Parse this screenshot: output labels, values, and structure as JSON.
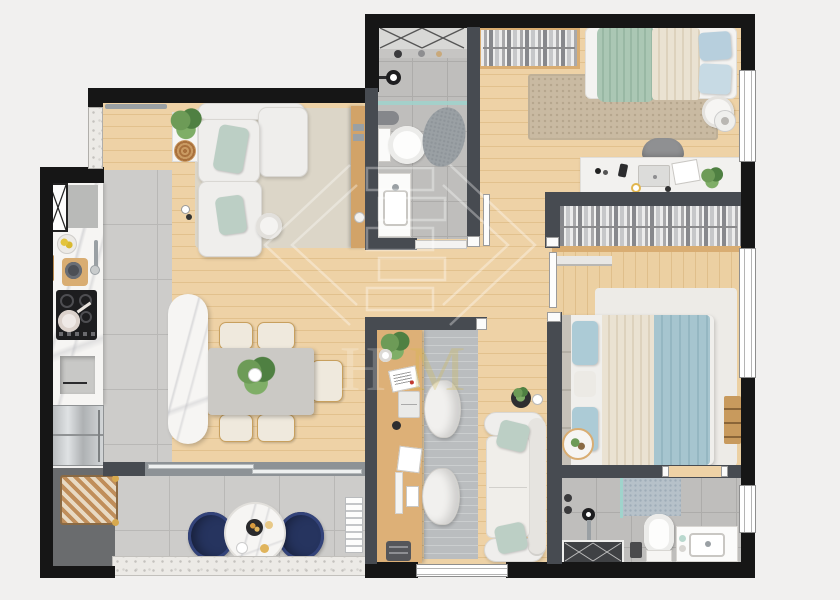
{
  "title": "3D apartment floor plan render",
  "watermark": {
    "letter_h": "H",
    "letter_m": "M",
    "letter_m_color": "#d4b83c",
    "line_color": "#ffffff"
  },
  "palette": {
    "background": "#f1f0ef",
    "outer_wall": "#161616",
    "inner_wall": "#474b51",
    "wood_floor": "#ecd0a2",
    "gray_tile": "#cdccca",
    "bath_tile": "#bfbebc",
    "marble": "#f6f5f3",
    "sofa_white": "#efeeec",
    "mint_pillow": "#bccfc5",
    "sage_bedding": "#abc7b4",
    "cream_bedding": "#eae2d2",
    "sky_pillow": "#b7cfdd",
    "master_blue_bedding": "#a6c5cf",
    "navy_chair": "#26345f",
    "beige_rug": "#d9d2c4",
    "office_rug": "#babdbf",
    "desk_wood": "#ddb077",
    "glass": "#9fd4cc",
    "terrazzo_ledge": "#eceae6",
    "steel_fridge": "#c6c9cb"
  },
  "rooms": [
    {
      "name": "Living room",
      "floor": "wood",
      "furniture": [
        "L-shaped white sofa",
        "mint throw pillows",
        "plant on stand",
        "storage basket",
        "round coffee table",
        "wood console",
        "beige rug",
        "curtain rail"
      ]
    },
    {
      "name": "Kitchen",
      "floor": "gray tile",
      "furniture": [
        "tall cabinet",
        "marble counter",
        "fruit bowl",
        "cutting board with pot",
        "utensils",
        "faucet",
        "4-burner cooktop with pan",
        "open shelf niche",
        "stainless refrigerator"
      ]
    },
    {
      "name": "Dining area",
      "floor": "wood",
      "furniture": [
        "marble island",
        "gray dining table",
        "five cream chairs",
        "plant centerpiece"
      ]
    },
    {
      "name": "Hallway",
      "floor": "wood",
      "furniture": []
    },
    {
      "name": "Bathroom 1",
      "floor": "gray tile",
      "furniture": [
        "walk-in shower",
        "shower head",
        "glass partition",
        "wall sprayer",
        "toilet",
        "stone rug",
        "vanity with sink"
      ]
    },
    {
      "name": "Bedroom 1",
      "floor": "wood",
      "furniture": [
        "open wardrobe with clothes",
        "single bed",
        "sage and cream blankets",
        "blue pillows",
        "woven rug",
        "round side table",
        "lamp",
        "white desk",
        "laptop",
        "phone",
        "notebook",
        "mug",
        "potted plant",
        "desk chair"
      ]
    },
    {
      "name": "Master bedroom",
      "floor": "wood",
      "furniture": [
        "open wardrobe with clothes",
        "wall shelf",
        "double bed",
        "blue and cream bedding",
        "white rug",
        "window bench",
        "decor plate"
      ]
    },
    {
      "name": "Bathroom 2",
      "floor": "gray tile",
      "furniture": [
        "shower tray",
        "glass partition",
        "shower column",
        "toilet",
        "waste bin",
        "vanity with sink",
        "mosaic mat"
      ]
    },
    {
      "name": "Home office",
      "floor": "wood",
      "furniture": [
        "wood desk",
        "plant",
        "paper roll",
        "magazine",
        "laptop",
        "mug",
        "documents",
        "keyboard",
        "storage box",
        "printer",
        "two white swivel chairs",
        "gray rug",
        "two-seat sofa",
        "mint pillows",
        "plant tray"
      ]
    },
    {
      "name": "Balcony",
      "floor": "large gray tile",
      "furniture": [
        "two navy armchairs",
        "round marble table",
        "serving tray",
        "plates",
        "wicker bench",
        "AC unit",
        "terrazzo ledge"
      ]
    }
  ]
}
